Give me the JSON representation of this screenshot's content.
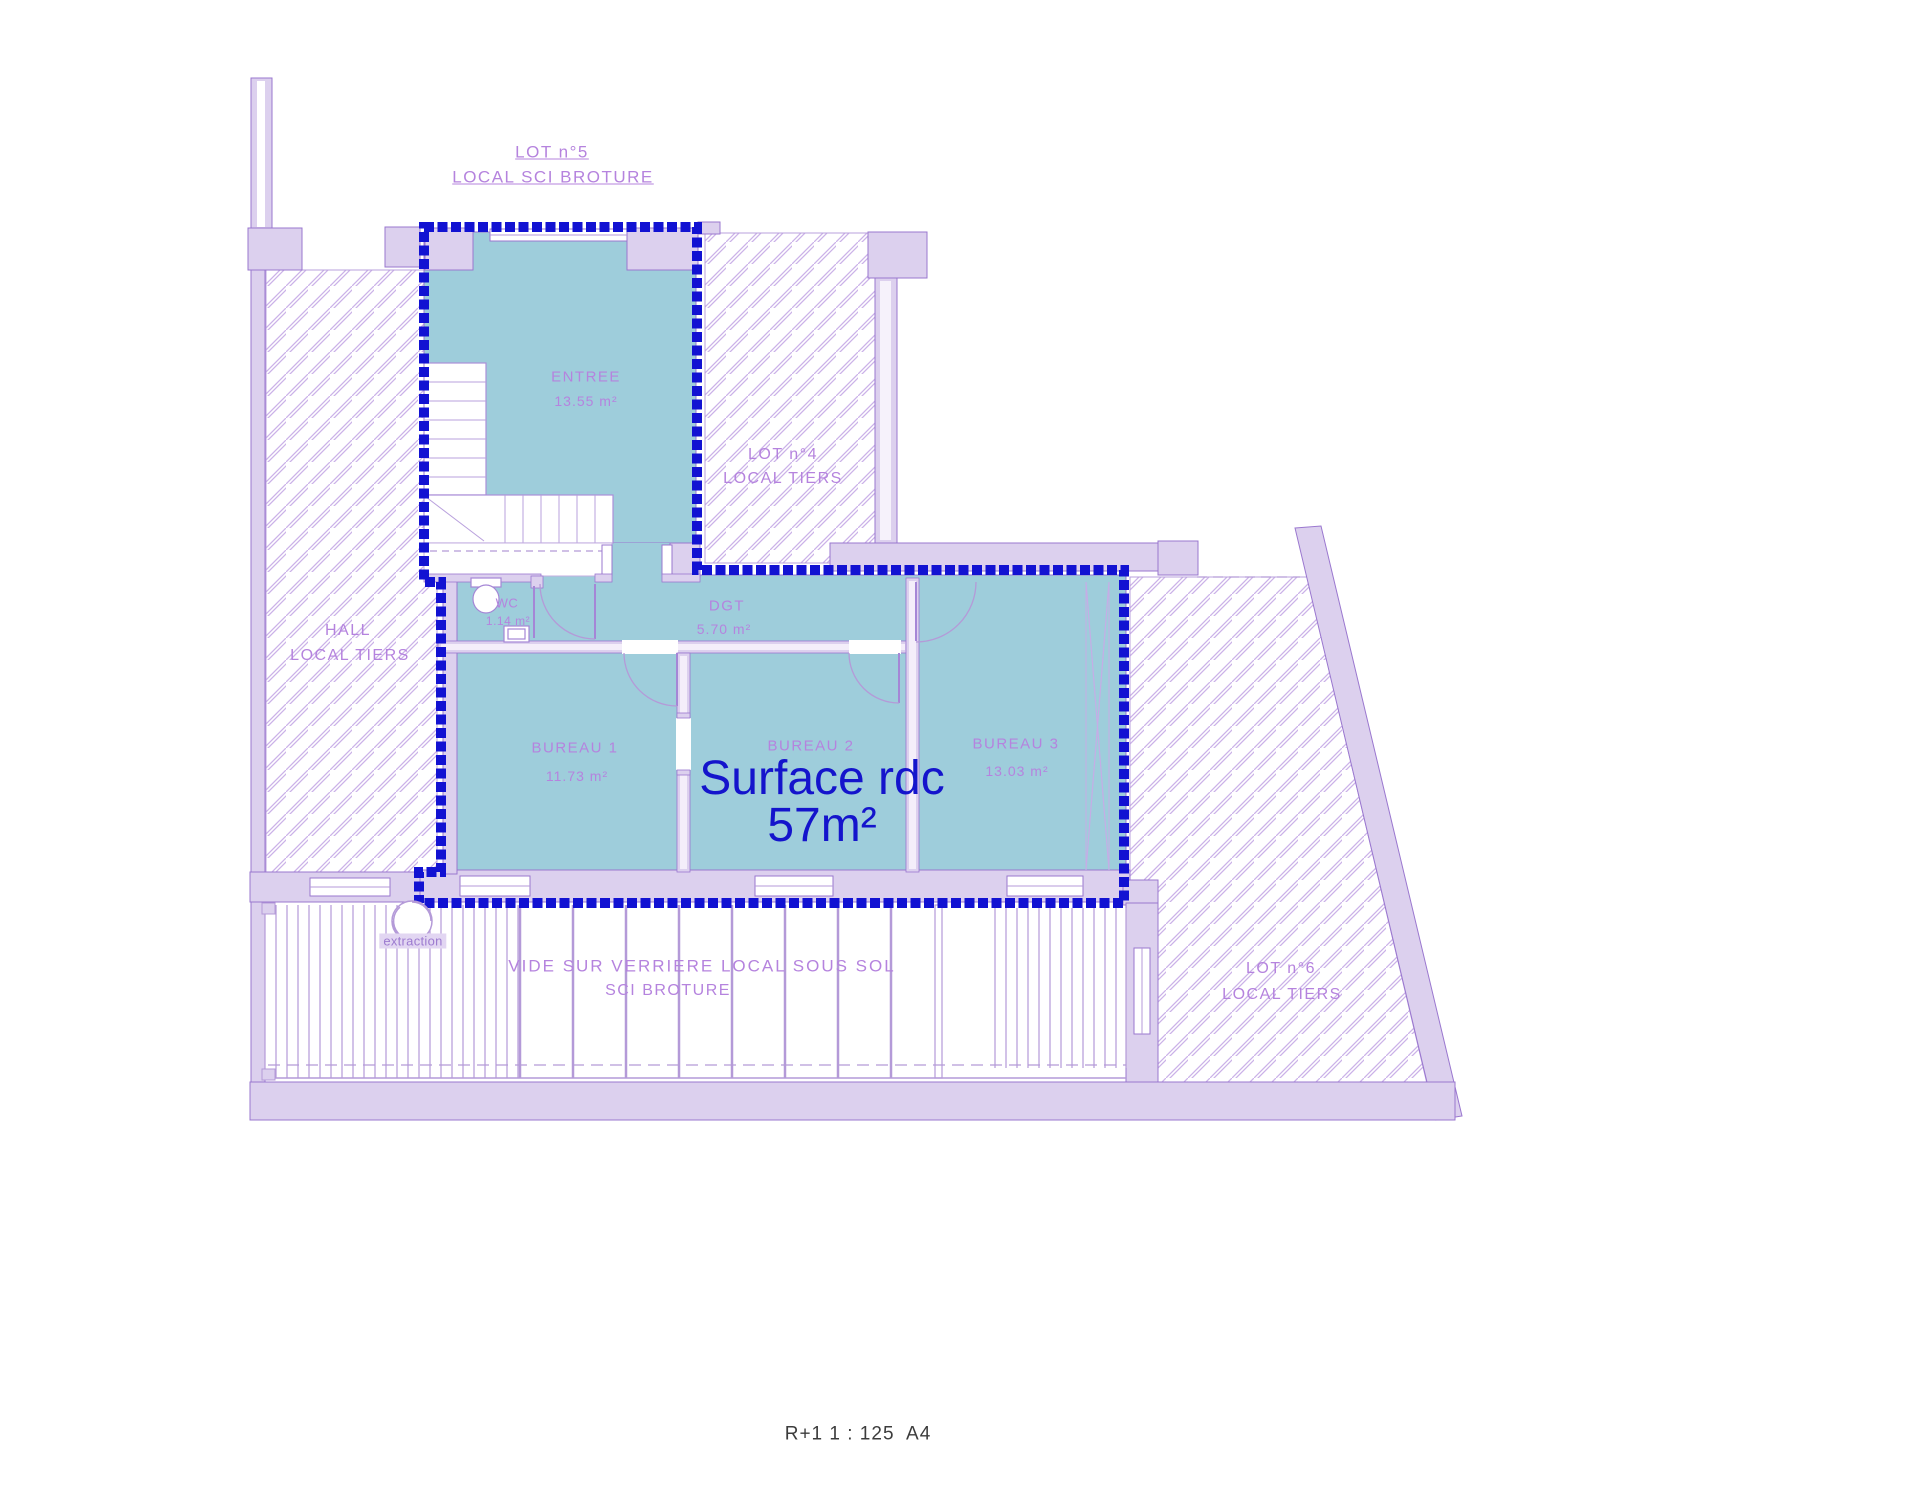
{
  "colors": {
    "wall_fill": "#dcd0ee",
    "wall_stroke": "#9a77cf",
    "hatch_line": "#cbb2e8",
    "room_fill_teal": "#9ecddb",
    "lot_boundary_blue": "#1212d2",
    "label_purple": "#b583de",
    "surface_note_blue": "#1414cc",
    "caption_gray": "#3c3c3c"
  },
  "lot5": {
    "line1": "LOT n°5",
    "line2": "LOCAL SCI BROTURE"
  },
  "lot4": {
    "line1": "LOT n°4",
    "line2": "LOCAL TIERS"
  },
  "hall": {
    "line1": "HALL",
    "line2": "LOCAL TIERS"
  },
  "lot6": {
    "line1": "LOT n°6",
    "line2": "LOCAL TIERS"
  },
  "rooms": {
    "entree": {
      "name": "ENTREE",
      "area": "13.55 m²"
    },
    "wc": {
      "name": "WC",
      "area": "1.14 m²"
    },
    "dgt": {
      "name": "DGT",
      "area": "5.70 m²"
    },
    "bureau1": {
      "name": "BUREAU 1",
      "area": "11.73 m²"
    },
    "bureau2": {
      "name": "BUREAU 2"
    },
    "bureau3": {
      "name": "BUREAU 3",
      "area": "13.03 m²"
    }
  },
  "surface_note": {
    "line1": "Surface rdc",
    "line2": "57m²"
  },
  "vide_note": {
    "line1": "VIDE SUR VERRIERE LOCAL SOUS SOL",
    "line2": "SCI BROTURE"
  },
  "extraction_label": "extraction",
  "caption": "R+1 1 : 125  A4"
}
